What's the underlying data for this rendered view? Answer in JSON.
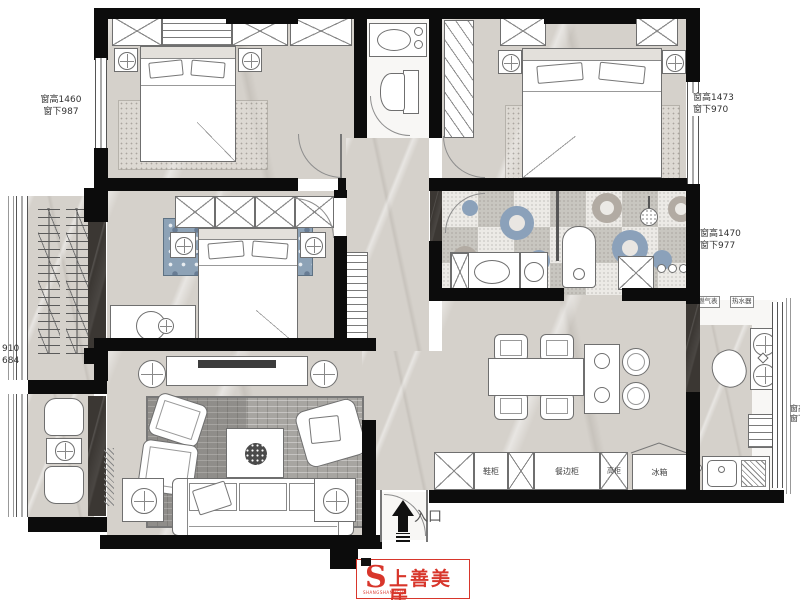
{
  "colors": {
    "wall": "#0c0c0c",
    "floor_marble": "#d5d1cb",
    "floor_white": "#f8f7f5",
    "dark_marble": "#3b3733",
    "tile_circle_blue": "#8ba1ba",
    "logo_red": "#d8362b"
  },
  "window_labels": {
    "top_left": [
      "窗高1460",
      "窗下987"
    ],
    "top_right": [
      "窗高1473",
      "窗下970"
    ],
    "mid_right": [
      "窗高1470",
      "窗下977"
    ],
    "left_edge": [
      "910",
      "684"
    ],
    "bottom_right_edge": [
      "窗高",
      "窗下"
    ]
  },
  "room_labels": {
    "entrance": "入口",
    "shoe_cabinet": "鞋柜",
    "sideboard": "餐边柜",
    "tall_cabinet": "高柜",
    "fridge": "冰箱",
    "gas_meter": "燃气表",
    "water_heater": "热水器"
  },
  "logo": {
    "mark": "S",
    "name": "上善美居",
    "sub": "SHANGSHANMEIJU"
  }
}
